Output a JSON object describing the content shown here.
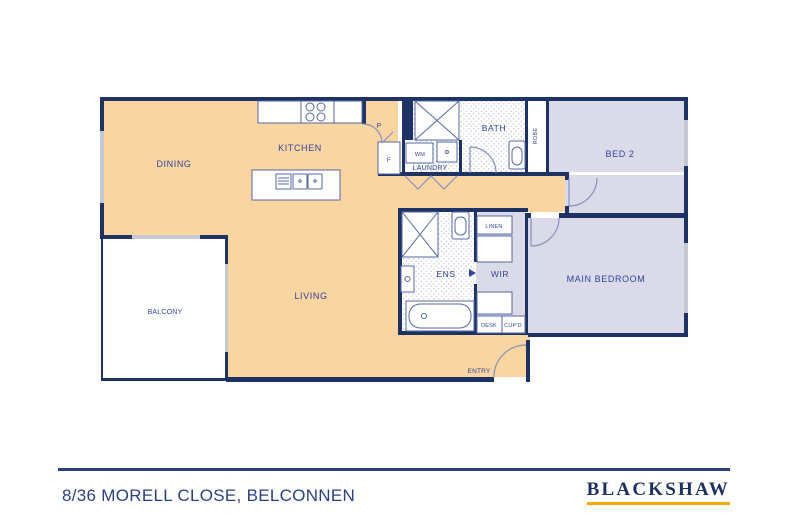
{
  "colors": {
    "wall_navy": "#1E3264",
    "floor_orange": "#F9D5A1",
    "floor_lavender": "#DBDAE8",
    "window_gray": "#C5C7D1",
    "label_navy": "#33439A",
    "fixture_stroke": "#5667A3",
    "door_stroke": "#8590BC",
    "tile_dot": "#C9CCDA",
    "footer_navy": "#2B3F85",
    "brand_navy": "#1D2E5F",
    "brand_gold": "#F2A900"
  },
  "floorplan": {
    "rooms": {
      "dining": "DINING",
      "kitchen": "KITCHEN",
      "living": "LIVING",
      "balcony": "BALCONY",
      "laundry": "LAUNDRY",
      "bath": "BATH",
      "robe": "ROBE",
      "bed2": "BED 2",
      "main_bedroom": "MAIN BEDROOM",
      "ens": "ENS",
      "wir": "WIR",
      "linen": "LINEN",
      "desk": "DESK",
      "cupd": "CUP'D",
      "entry": "ENTRY",
      "pantry": "P",
      "fridge": "F",
      "washing_machine": "WM"
    }
  },
  "footer": {
    "address": "8/36 MORELL CLOSE, BELCONNEN",
    "brand": "BLACKSHAW"
  }
}
